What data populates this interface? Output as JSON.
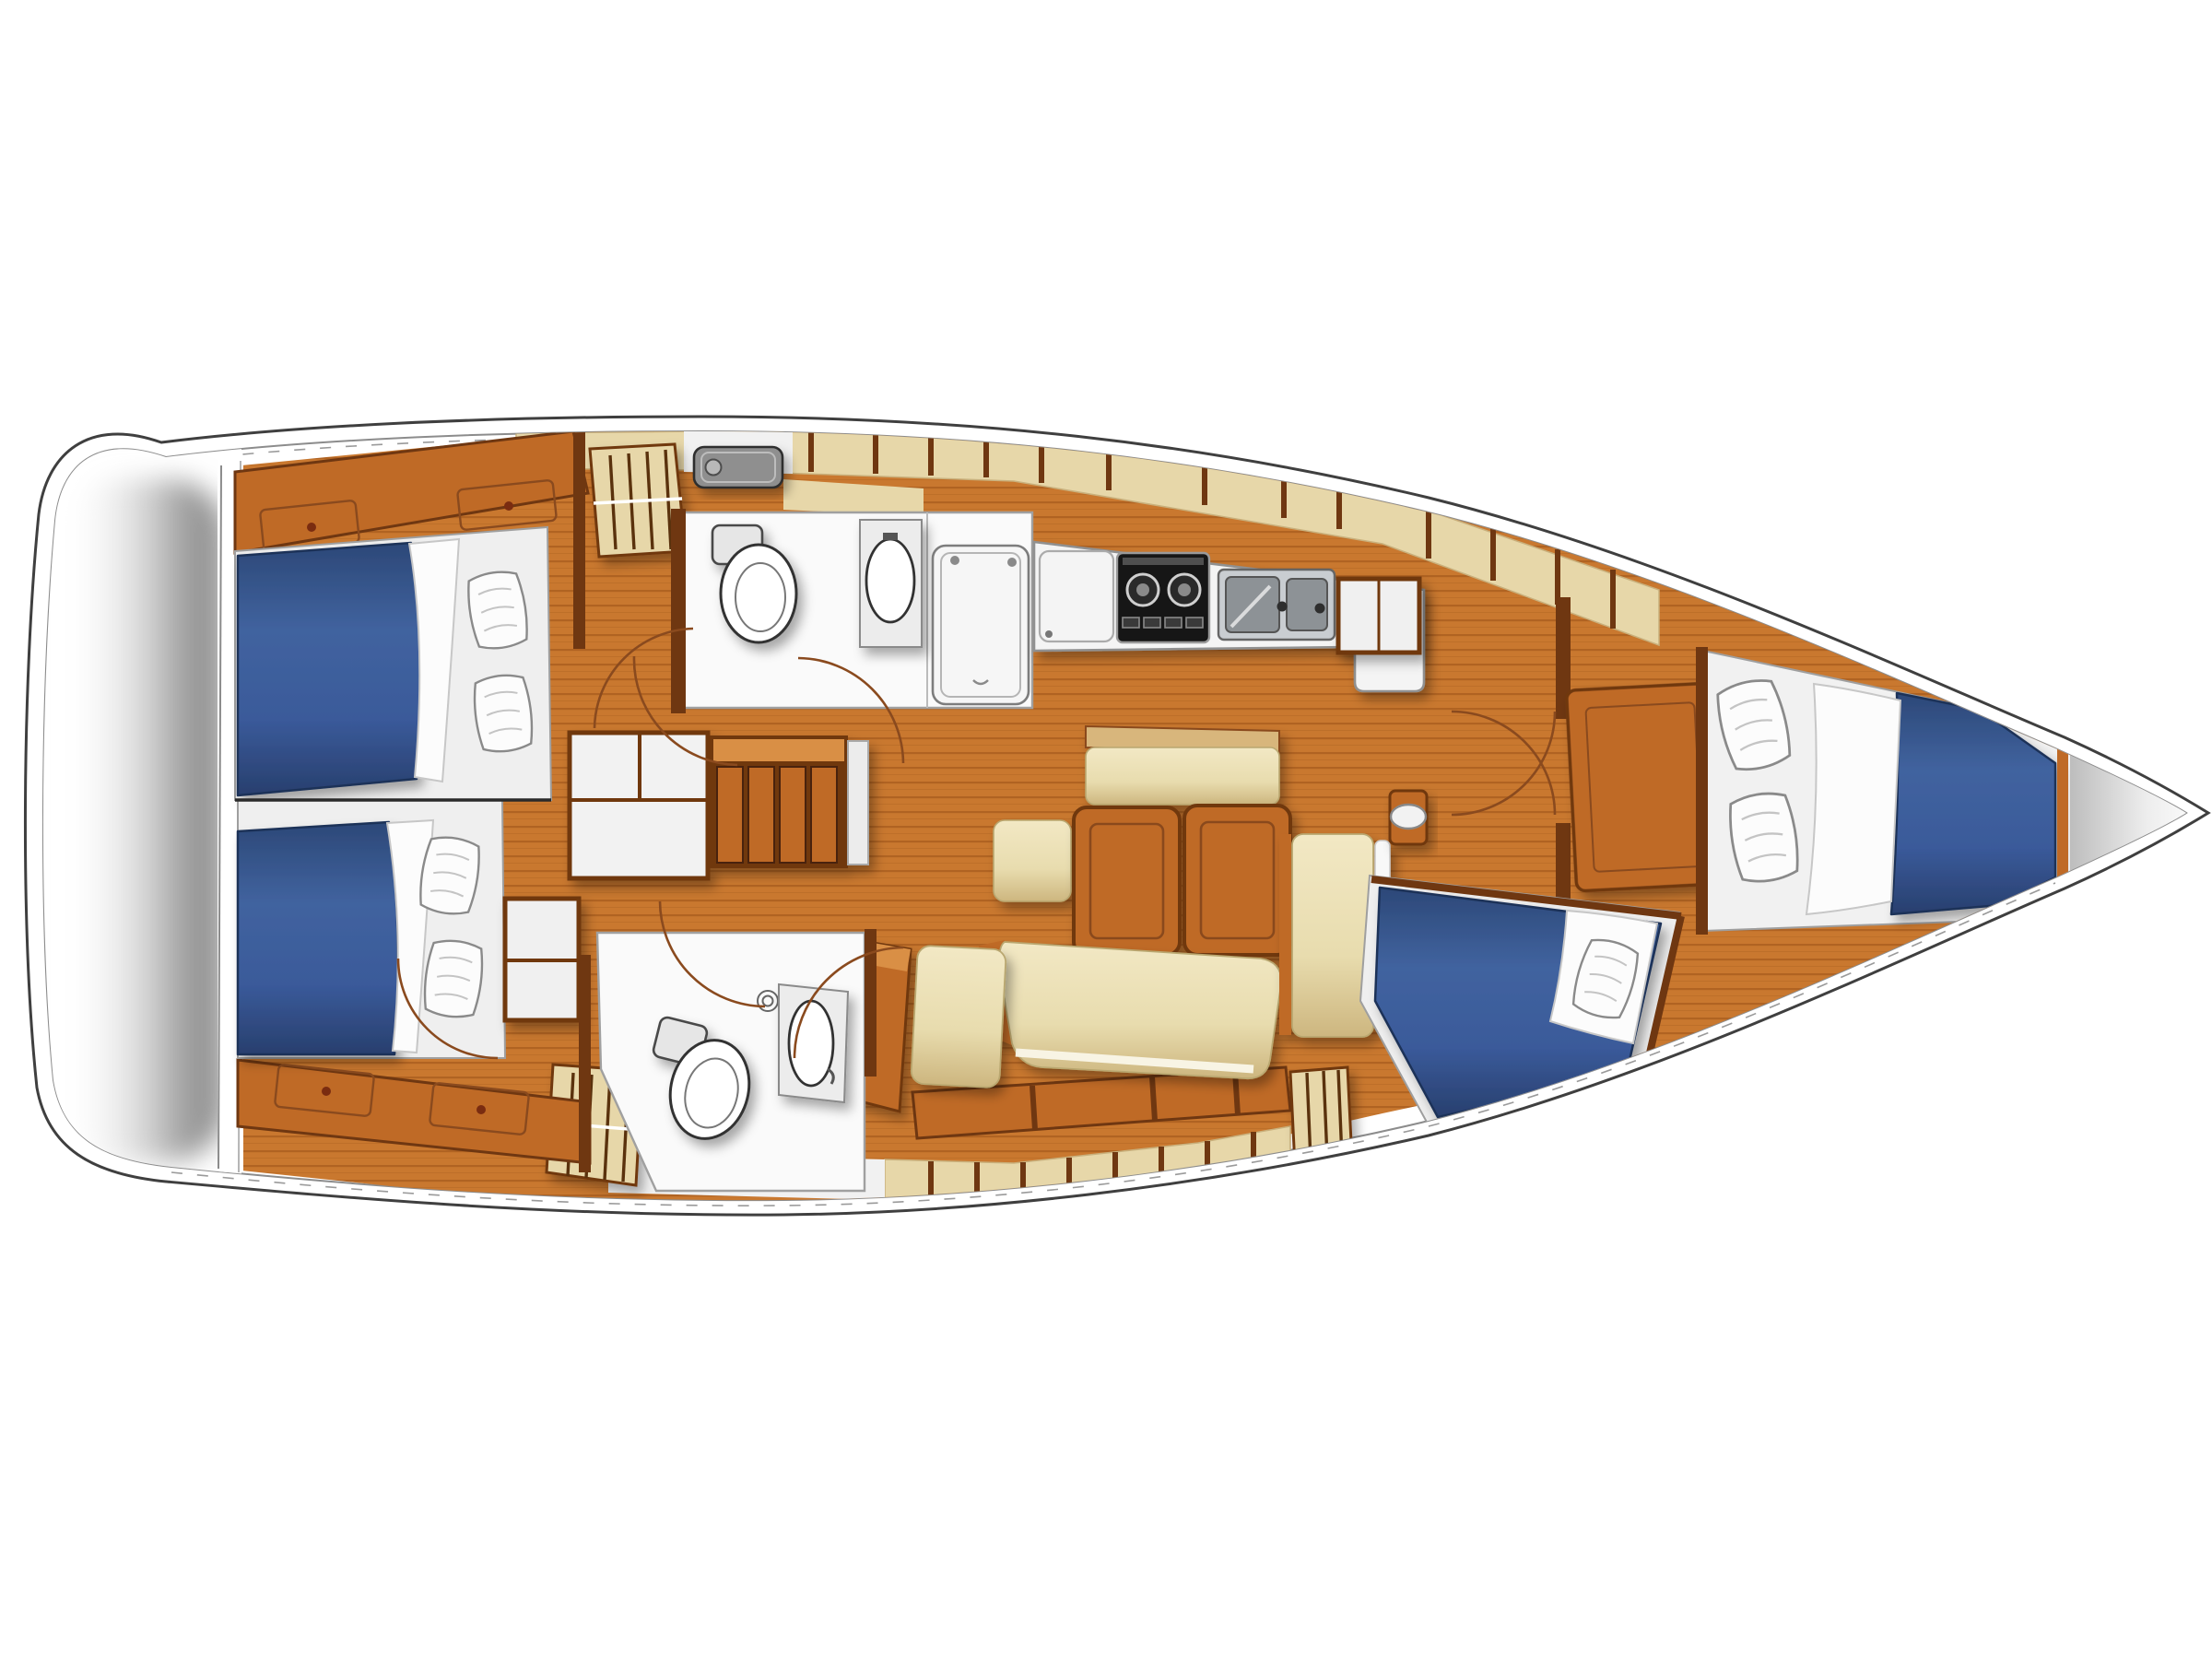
{
  "diagram": {
    "type": "yacht-interior-floor-plan",
    "orientation": {
      "bow": "right",
      "stern": "left",
      "view": "top-down"
    },
    "rooms": [
      {
        "id": "swim-platform",
        "name": "stern-swim-platform"
      },
      {
        "id": "aft-cabin-top",
        "name": "aft-double-cabin-top",
        "berths": 1,
        "pillows": 2
      },
      {
        "id": "aft-cabin-bottom",
        "name": "aft-double-cabin-bottom",
        "berths": 1,
        "pillows": 2
      },
      {
        "id": "companionway",
        "name": "companionway-steps"
      },
      {
        "id": "aft-head",
        "name": "head-with-shower-top",
        "fixtures": [
          "toilet",
          "washbasin",
          "shower-tray",
          "deck-hatch"
        ]
      },
      {
        "id": "galley",
        "name": "l-shaped-galley",
        "burners": 2,
        "sink-bowls": 2,
        "fixtures": [
          "fridge",
          "stove",
          "double-sink"
        ]
      },
      {
        "id": "saloon",
        "name": "saloon",
        "fixtures": [
          "folding-table-two-leaves",
          "u-settee",
          "stool",
          "bench",
          "mast-post"
        ]
      },
      {
        "id": "mid-head",
        "name": "head-bottom",
        "fixtures": [
          "toilet",
          "washbasin",
          "deck-hatch"
        ]
      },
      {
        "id": "desk",
        "name": "desk-with-seat"
      },
      {
        "id": "forward-berth",
        "name": "angled-berth-forward-bottom",
        "pillows": 1
      },
      {
        "id": "forward-cabin",
        "name": "forward-double-cabin",
        "pillows": 2,
        "fixtures": [
          "wardrobe",
          "hull-lockers",
          "cabin-door"
        ]
      },
      {
        "id": "bow",
        "name": "bow-compartment"
      }
    ],
    "colors": {
      "page_bg": "#ffffff",
      "outline": "#3f3f3f",
      "deck_line": "#8c8c8c",
      "stern_shadow": "#9e9e9e",
      "floor": "#c9782f",
      "floor_line": "#b06322",
      "wood": "#bf6a26",
      "wood_light": "#d98f45",
      "wood_dark": "#6f3711",
      "wood_frame": "#8a4a1e",
      "locker_beige": "#e7d7a9",
      "locker_line": "#c9b07c",
      "cushion": "#ecdfb2",
      "cushion_dark": "#d3bd85",
      "mattress": "#3c5d9f",
      "mattress_dark": "#27406f",
      "linen": "#fcfcfc",
      "linen_shadow": "#bdbdbd",
      "fixture_white": "#f7f7f7",
      "fixture_line": "#4a4a4a",
      "room_white": "#fafafa",
      "hatch": "#8f8f8f",
      "hatch_dark": "#2f2f2f",
      "stove": "#161616",
      "steel": "#c9cdd1",
      "steel_dark": "#8d9296"
    }
  }
}
